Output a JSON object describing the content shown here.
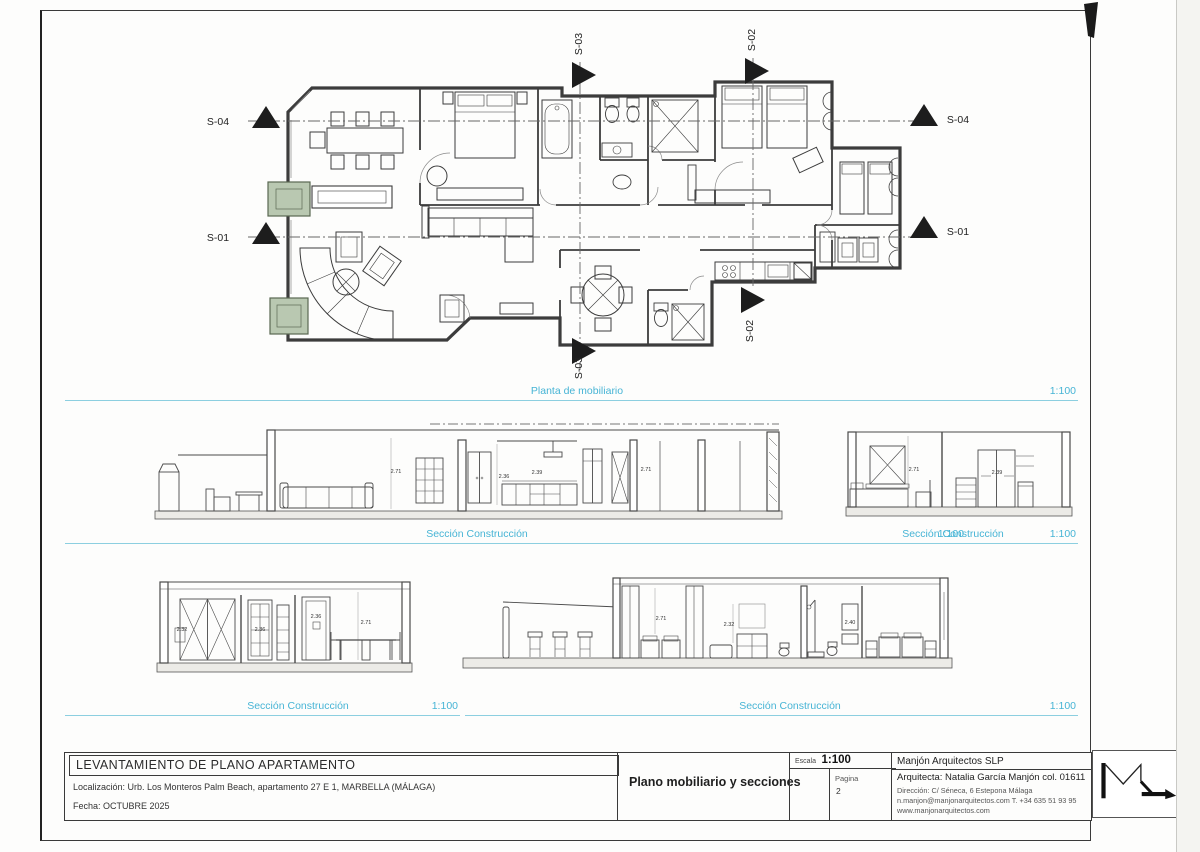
{
  "page": {
    "plan": {
      "title": "Planta de mobiliario",
      "scale": "1:100"
    },
    "sections": {
      "a": {
        "title": "Sección Construcción",
        "scale": "1:100"
      },
      "b": {
        "title": "Sección Construcción",
        "scale": "1:100"
      },
      "c": {
        "title": "Sección Construcción",
        "scale": "1:100"
      },
      "d": {
        "title": "Sección Construcción",
        "scale": "1:100"
      }
    },
    "markers": {
      "s01": "S-01",
      "s02": "S-02",
      "s03": "S-03",
      "s04": "S-04"
    },
    "dims": {
      "a": [
        "2.71",
        "2.36",
        "2.39",
        "2.71"
      ],
      "b": [
        "2.71",
        "2.39"
      ],
      "c": [
        "2.32",
        "2.36",
        "2.36",
        "2.71"
      ],
      "d": [
        "2.71",
        "2.32",
        "2.40"
      ]
    },
    "titleblock": {
      "project": "LEVANTAMIENTO DE PLANO APARTAMENTO",
      "location_label": "Localización:",
      "location": "Urb. Los Monteros Palm Beach, apartamento 27 E 1, MARBELLA (MÁLAGA)",
      "date_label": "Fecha:",
      "date": "OCTUBRE 2025",
      "drawing": "Plano mobiliario y secciones",
      "scale_label": "Escala",
      "scale": "1:100",
      "page_label": "Pagina",
      "page": "2",
      "firm": "Manjón Arquitectos SLP",
      "architect": "Arquitecta: Natalia García Manjón col. 01611",
      "address": "Dirección: C/ Séneca, 6 Estepona Málaga",
      "contact": "n.manjon@manjonarquitectos.com T. +34 635 51 93 95",
      "web": "www.manjonarquitectos.com"
    },
    "colors": {
      "accent": "#46b4d5",
      "line": "#3c3c3c",
      "column_fill": "#b9c8b1"
    }
  }
}
